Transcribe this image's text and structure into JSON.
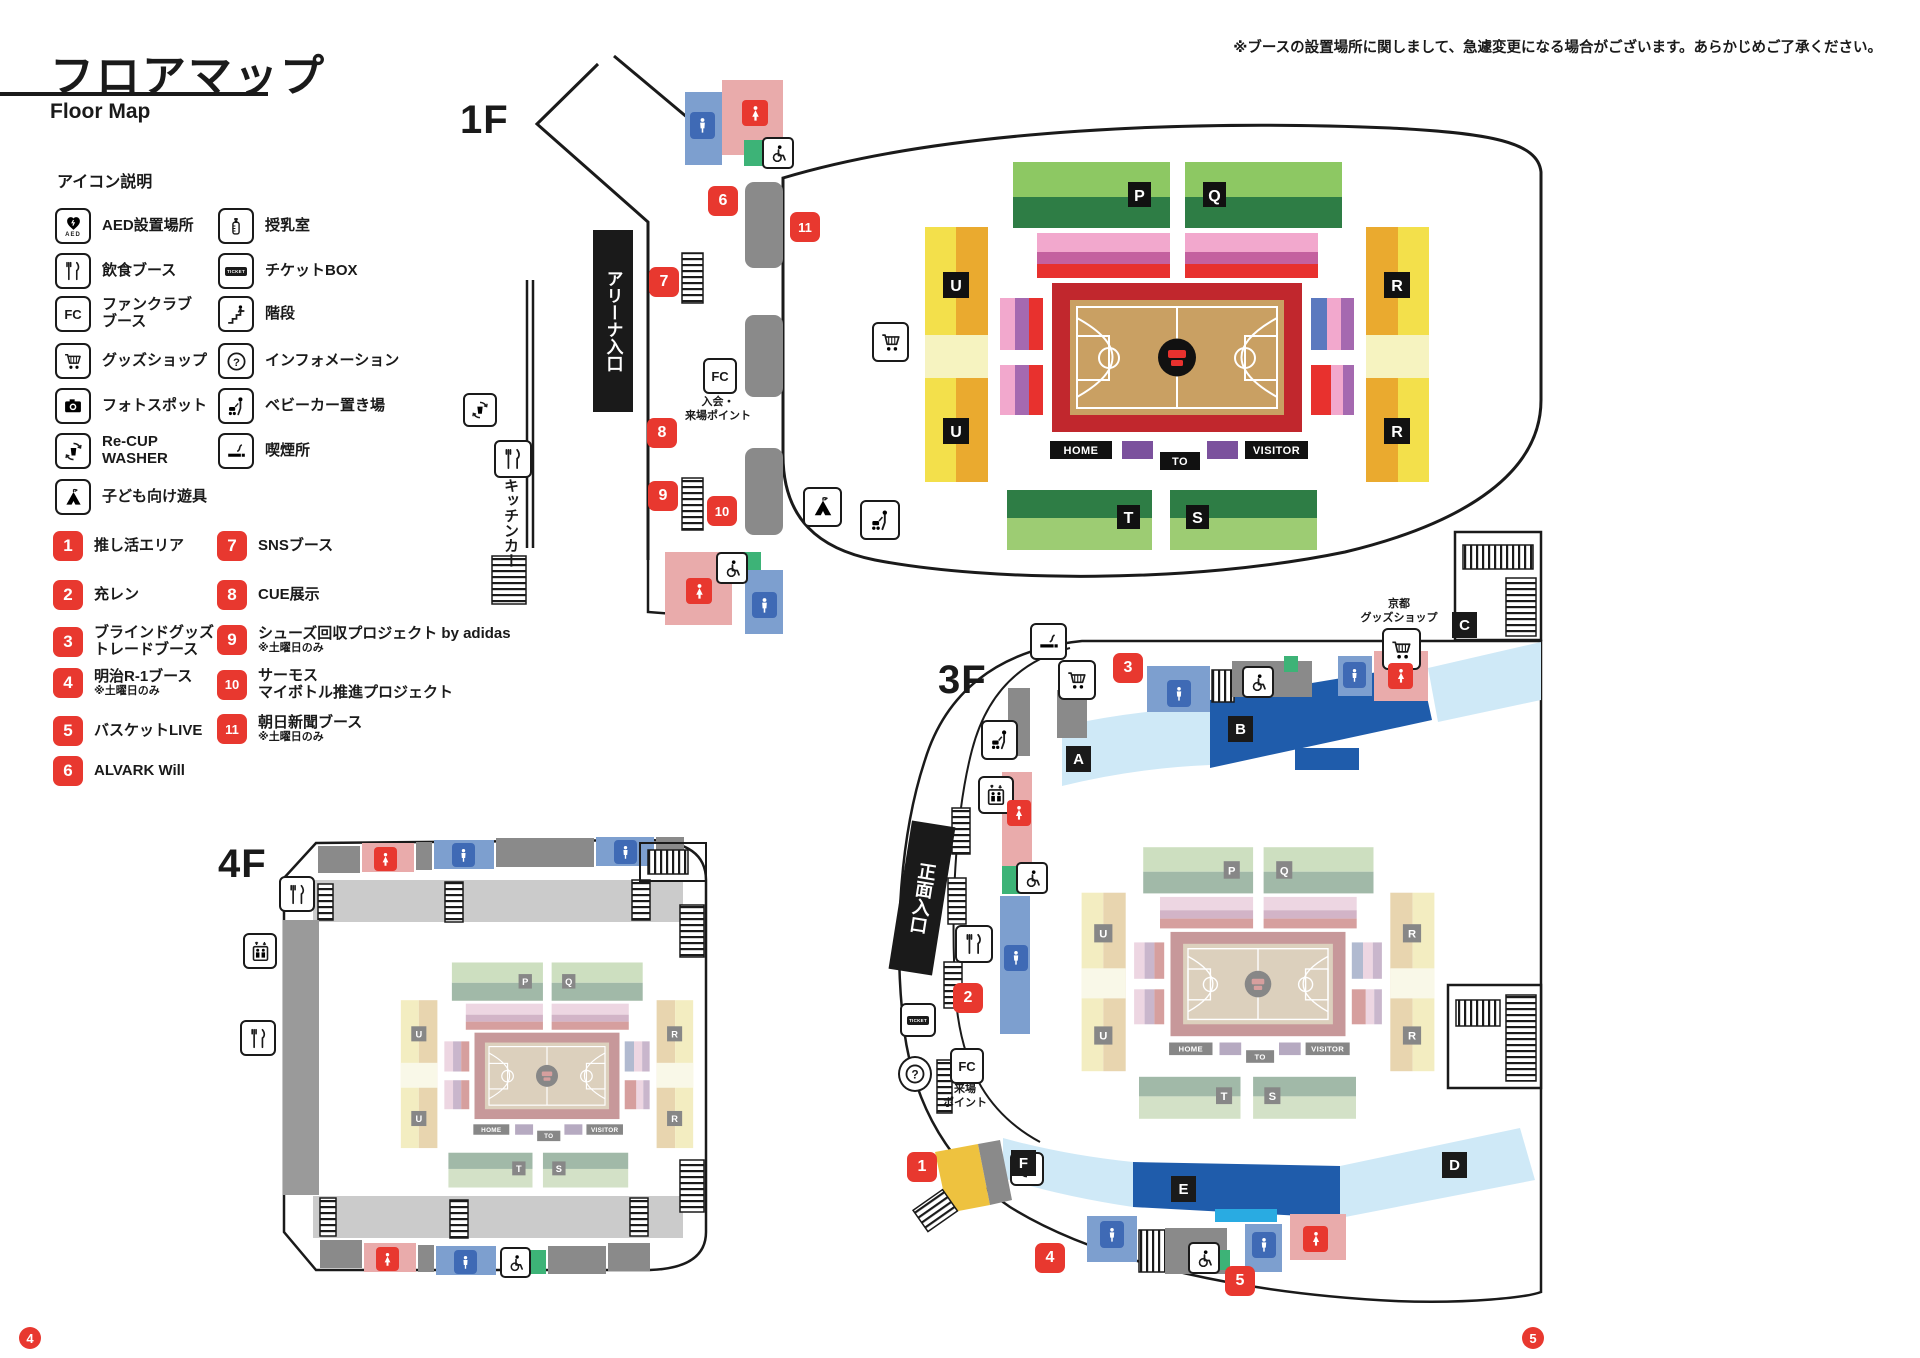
{
  "page": {
    "title_jp": "フロアマップ",
    "title_en": "Floor Map",
    "disclaimer": "※ブースの設置場所に関しまして、急遽変更になる場合がございます。あらかじめご了承ください。",
    "page_left": "4",
    "page_right": "5"
  },
  "legend": {
    "heading": "アイコン説明",
    "icons": [
      {
        "icon": "aed-icon",
        "label": "AED設置場所",
        "label2": "",
        "glyph_text": "AED"
      },
      {
        "icon": "food-icon",
        "label": "飲食ブース",
        "label2": ""
      },
      {
        "icon": "fanclub-icon",
        "label": "ファンクラブ",
        "label2": "ブース",
        "glyph_text": "FC"
      },
      {
        "icon": "goods-icon",
        "label": "グッズショップ",
        "label2": ""
      },
      {
        "icon": "photo-icon",
        "label": "フォトスポット",
        "label2": ""
      },
      {
        "icon": "recup-icon",
        "label": "Re-CUP",
        "label2": "WASHER"
      },
      {
        "icon": "kids-icon",
        "label": "子ども向け遊具",
        "label2": ""
      },
      {
        "icon": "nursing-icon",
        "label": "授乳室",
        "label2": ""
      },
      {
        "icon": "ticket-icon",
        "label": "チケットBOX",
        "label2": "",
        "glyph_text": "TICKET"
      },
      {
        "icon": "stairs-icon",
        "label": "階段",
        "label2": ""
      },
      {
        "icon": "info-icon",
        "label": "インフォメーション",
        "label2": ""
      },
      {
        "icon": "stroller-icon",
        "label": "ベビーカー置き場",
        "label2": ""
      },
      {
        "icon": "smoking-icon",
        "label": "喫煙所",
        "label2": ""
      }
    ],
    "booths": [
      {
        "num": "1",
        "label": "推し活エリア",
        "label2": "",
        "note": ""
      },
      {
        "num": "2",
        "label": "充レン",
        "label2": "",
        "note": ""
      },
      {
        "num": "3",
        "label": "ブラインドグッズ",
        "label2": "トレードブース",
        "note": ""
      },
      {
        "num": "4",
        "label": "明治R-1ブース",
        "label2": "",
        "note": "※土曜日のみ"
      },
      {
        "num": "5",
        "label": "バスケットLIVE",
        "label2": "",
        "note": ""
      },
      {
        "num": "6",
        "label": "ALVARK Will",
        "label2": "",
        "note": ""
      },
      {
        "num": "7",
        "label": "SNSブース",
        "label2": "",
        "note": ""
      },
      {
        "num": "8",
        "label": "CUE展示",
        "label2": "",
        "note": ""
      },
      {
        "num": "9",
        "label": "シューズ回収プロジェクト by adidas",
        "label2": "",
        "note": "※土曜日のみ"
      },
      {
        "num": "10",
        "label": "サーモス",
        "label2": "マイボトル推進プロジェクト",
        "note": ""
      },
      {
        "num": "11",
        "label": "朝日新聞ブース",
        "label2": "",
        "note": "※土曜日のみ"
      }
    ]
  },
  "floors": {
    "f1": "1F",
    "f3": "3F",
    "f4": "4F"
  },
  "labels": {
    "arena_entrance": "アリーナ入口",
    "kitchen_car": "キッチンカー",
    "main_entrance": "正面入口",
    "fc1f_line1": "入会・",
    "fc1f_line2": "来場ポイント",
    "fc3f_line1": "来場",
    "fc3f_line2": "ポイント",
    "kyoto_line1": "京都",
    "kyoto_line2": "グッズショップ",
    "fc_glyph": "FC",
    "ticket_glyph": "TICKET"
  },
  "court": {
    "p": "P",
    "q": "Q",
    "r": "R",
    "s": "S",
    "t": "T",
    "u": "U",
    "home": "HOME",
    "to": "TO",
    "visitor": "VISITOR"
  },
  "stands": {
    "a": "A",
    "b": "B",
    "c": "C",
    "d": "D",
    "e": "E",
    "f": "F"
  }
}
